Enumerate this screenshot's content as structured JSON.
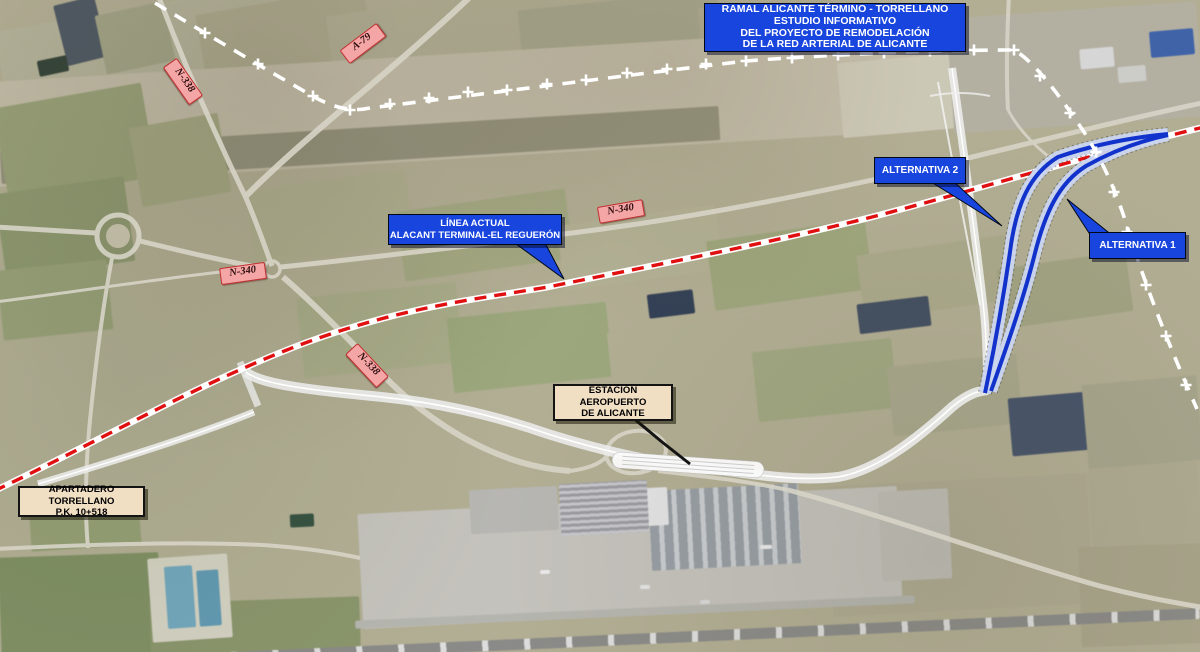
{
  "map": {
    "title_box": {
      "lines": [
        "RAMAL ALICANTE TÉRMINO - TORRELLANO",
        "ESTUDIO INFORMATIVO",
        "DEL PROYECTO DE REMODELACIÓN",
        "DE LA RED ARTERIAL DE ALICANTE"
      ]
    },
    "callouts": {
      "linea_actual": {
        "line1": "LÍNEA ACTUAL",
        "line2": "ALACANT TERMINAL-EL REGUERÓN"
      },
      "alternativa_2": {
        "label": "ALTERNATIVA 2"
      },
      "alternativa_1": {
        "label": "ALTERNATIVA 1"
      },
      "estacion_aeropuerto": {
        "line1": "ESTACIÓN AEROPUERTO",
        "line2": "DE ALICANTE"
      },
      "apartadero": {
        "line1": "APARTADERO TORRELLANO",
        "line2": "P.K. 10+518"
      }
    },
    "road_signs": {
      "n338_north": "N-338",
      "a79": "A-79",
      "n340_west": "N-340",
      "n340_center": "N-340",
      "n338_south": "N-338"
    },
    "legend_colors": {
      "callout_blue": "#1845dd",
      "road_sign_pink": "#f4a5a5",
      "road_sign_border": "#c03030",
      "note_tan": "#f1dfc4",
      "existing_line_red": "#e01010",
      "alternative_blue": "#1232cc",
      "alternative_band": "#cbd6f1"
    }
  }
}
